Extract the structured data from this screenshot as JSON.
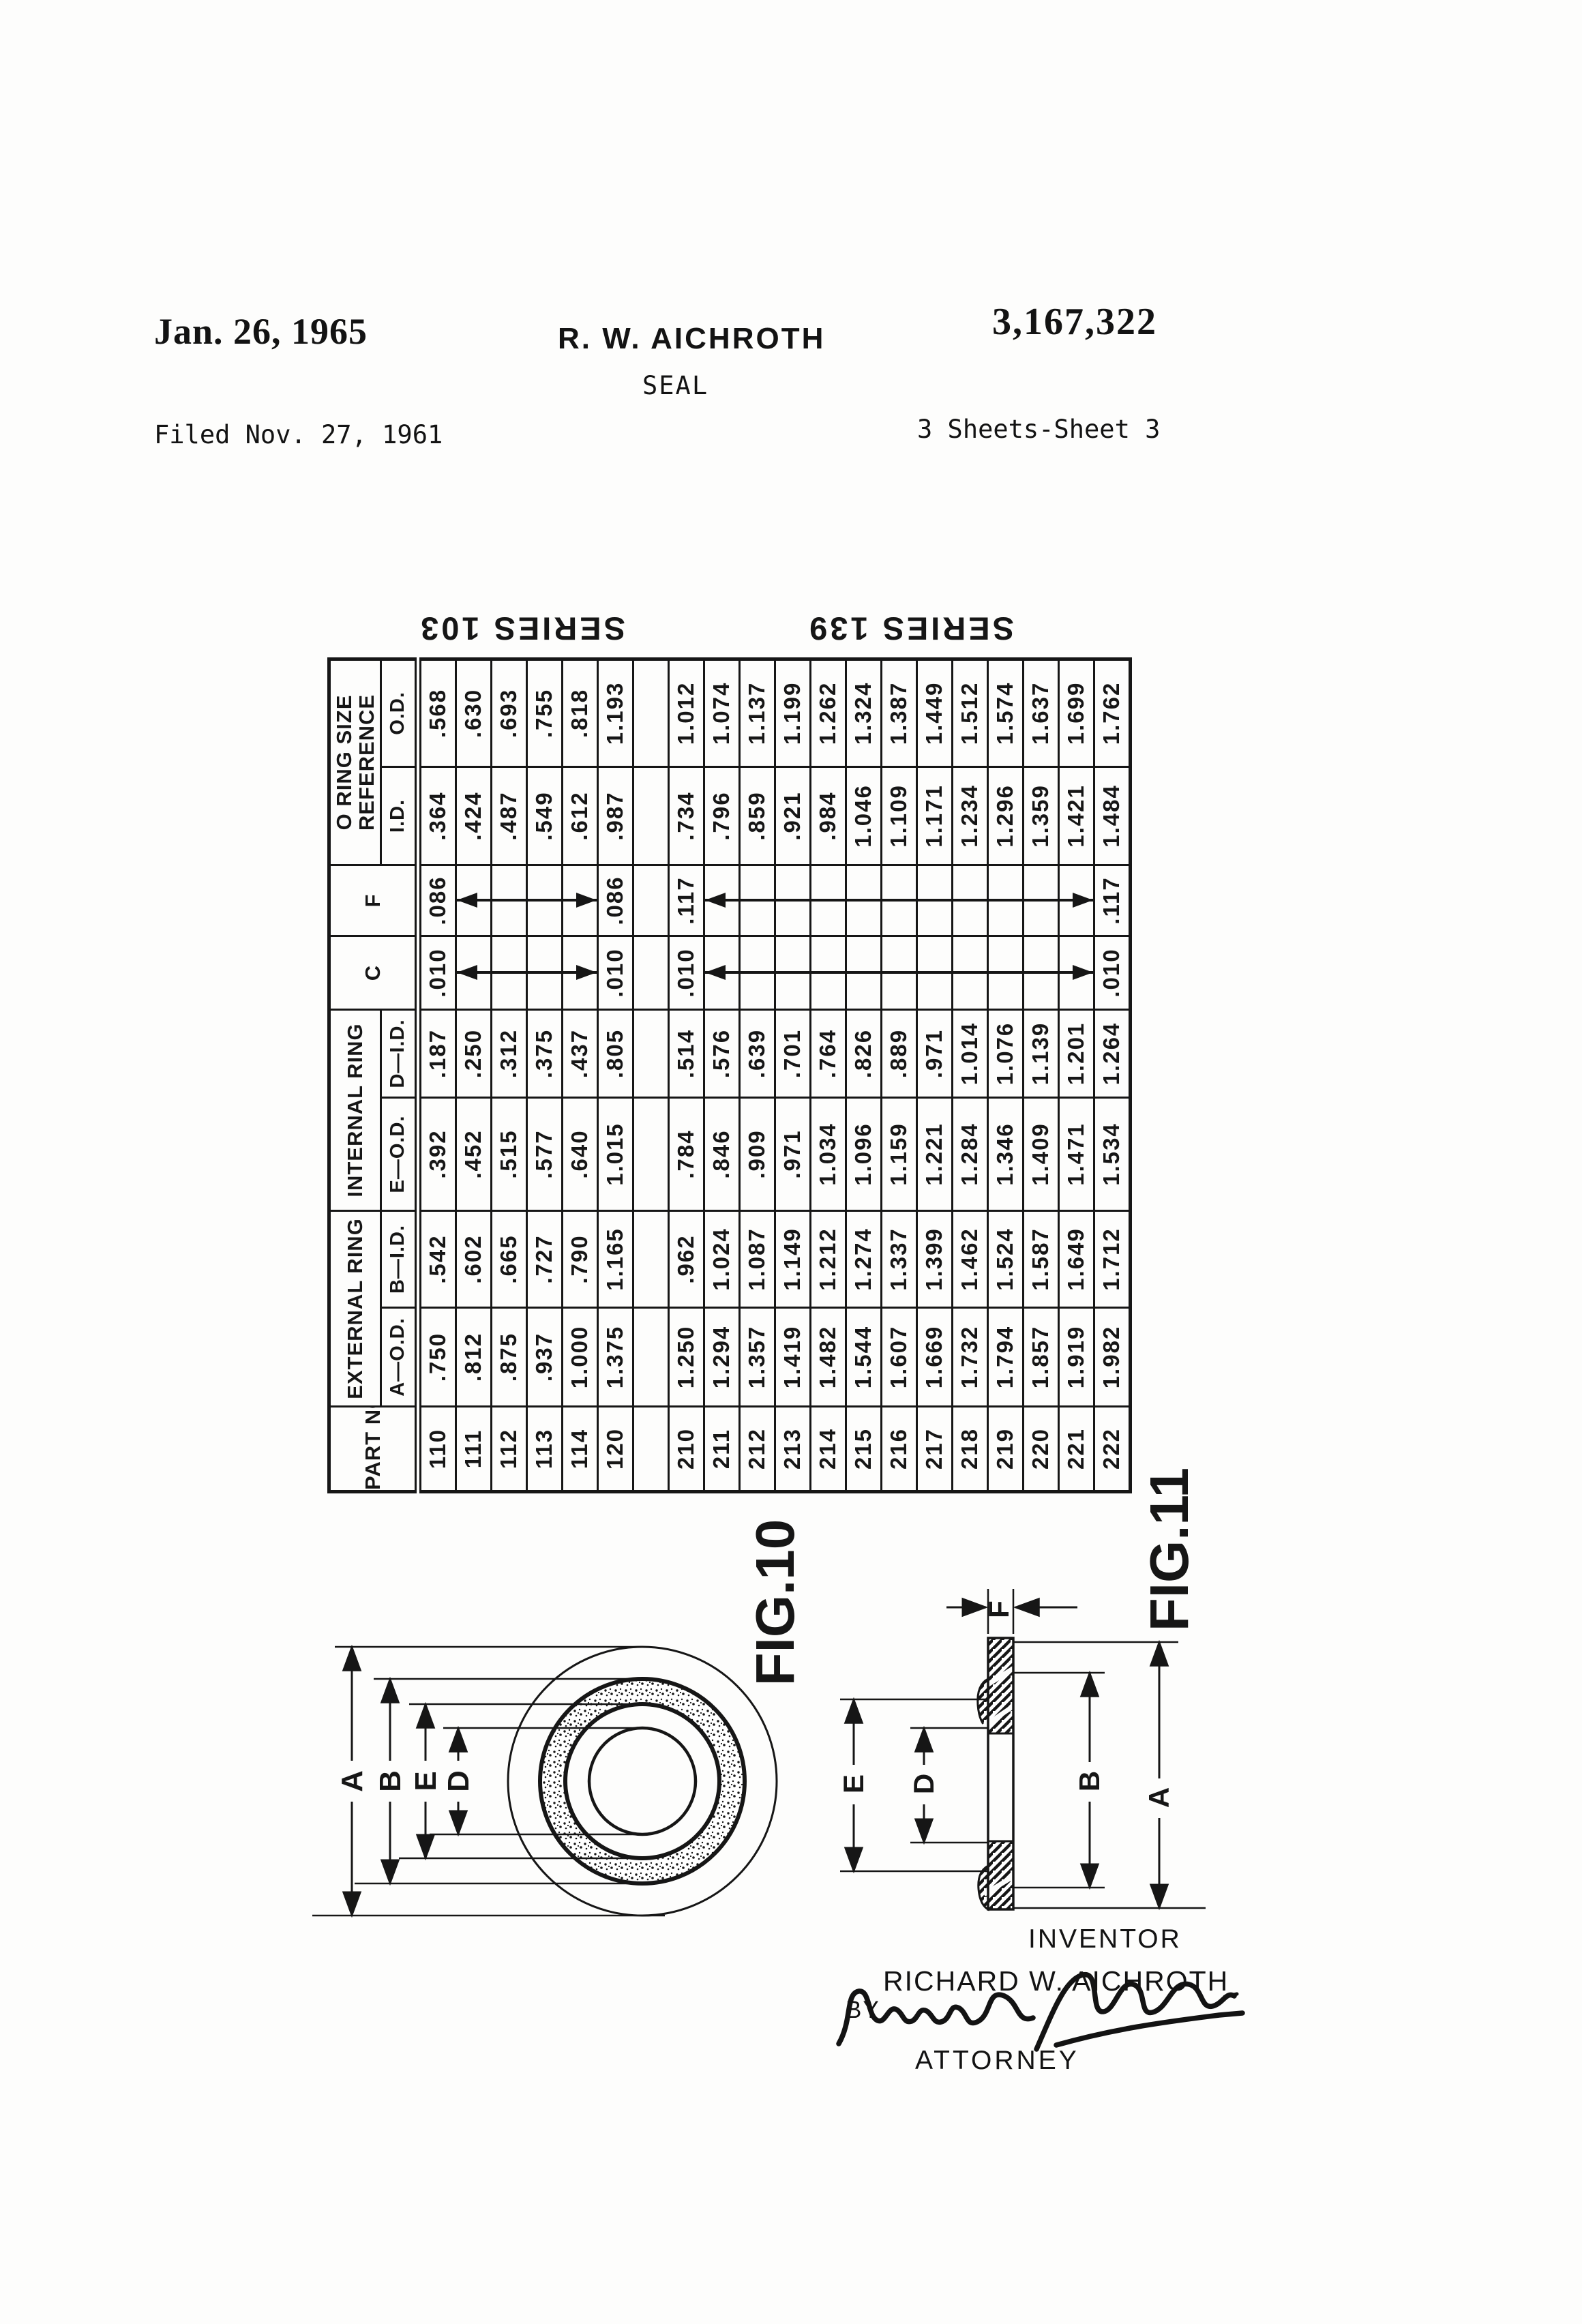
{
  "header": {
    "date": "Jan. 26, 1965",
    "author": "R. W. AICHROTH",
    "patent_number": "3,167,322",
    "title": "SEAL",
    "filed": "Filed Nov. 27, 1961",
    "sheet_info": "3 Sheets-Sheet 3"
  },
  "table": {
    "headers": {
      "part_no": "PART NO.",
      "external_ring": "EXTERNAL RING",
      "internal_ring": "INTERNAL RING",
      "c": "C",
      "f": "F",
      "o_ring_line1": "O RING SIZE",
      "o_ring_line2": "REFERENCE",
      "a_od": "A—O.D.",
      "b_id": "B—I.D.",
      "e_od": "E—O.D.",
      "d_id": "D—I.D.",
      "id": "I.D.",
      "od": "O.D."
    },
    "series_labels": [
      "SERIES 103",
      "SERIES 139"
    ],
    "columns": [
      "part",
      "a_od",
      "b_id",
      "e_od",
      "d_id",
      "c",
      "f",
      "id",
      "od"
    ],
    "rows": [
      {
        "part": "110",
        "a_od": ".750",
        "b_id": ".542",
        "e_od": ".392",
        "d_id": ".187",
        "c": ".010",
        "f": ".086",
        "id": ".364",
        "od": ".568"
      },
      {
        "part": "111",
        "a_od": ".812",
        "b_id": ".602",
        "e_od": ".452",
        "d_id": ".250",
        "c": "",
        "f": "",
        "id": ".424",
        "od": ".630"
      },
      {
        "part": "112",
        "a_od": ".875",
        "b_id": ".665",
        "e_od": ".515",
        "d_id": ".312",
        "c": "",
        "f": "",
        "id": ".487",
        "od": ".693"
      },
      {
        "part": "113",
        "a_od": ".937",
        "b_id": ".727",
        "e_od": ".577",
        "d_id": ".375",
        "c": "",
        "f": "",
        "id": ".549",
        "od": ".755"
      },
      {
        "part": "114",
        "a_od": "1.000",
        "b_id": ".790",
        "e_od": ".640",
        "d_id": ".437",
        "c": "",
        "f": "",
        "id": ".612",
        "od": ".818"
      },
      {
        "part": "120",
        "a_od": "1.375",
        "b_id": "1.165",
        "e_od": "1.015",
        "d_id": ".805",
        "c": ".010",
        "f": ".086",
        "id": ".987",
        "od": "1.193"
      },
      {
        "gap": true
      },
      {
        "part": "210",
        "a_od": "1.250",
        "b_id": ".962",
        "e_od": ".784",
        "d_id": ".514",
        "c": ".010",
        "f": ".117",
        "id": ".734",
        "od": "1.012"
      },
      {
        "part": "211",
        "a_od": "1.294",
        "b_id": "1.024",
        "e_od": ".846",
        "d_id": ".576",
        "c": "",
        "f": "",
        "id": ".796",
        "od": "1.074"
      },
      {
        "part": "212",
        "a_od": "1.357",
        "b_id": "1.087",
        "e_od": ".909",
        "d_id": ".639",
        "c": "",
        "f": "",
        "id": ".859",
        "od": "1.137"
      },
      {
        "part": "213",
        "a_od": "1.419",
        "b_id": "1.149",
        "e_od": ".971",
        "d_id": ".701",
        "c": "",
        "f": "",
        "id": ".921",
        "od": "1.199"
      },
      {
        "part": "214",
        "a_od": "1.482",
        "b_id": "1.212",
        "e_od": "1.034",
        "d_id": ".764",
        "c": "",
        "f": "",
        "id": ".984",
        "od": "1.262"
      },
      {
        "part": "215",
        "a_od": "1.544",
        "b_id": "1.274",
        "e_od": "1.096",
        "d_id": ".826",
        "c": "",
        "f": "",
        "id": "1.046",
        "od": "1.324"
      },
      {
        "part": "216",
        "a_od": "1.607",
        "b_id": "1.337",
        "e_od": "1.159",
        "d_id": ".889",
        "c": "",
        "f": "",
        "id": "1.109",
        "od": "1.387"
      },
      {
        "part": "217",
        "a_od": "1.669",
        "b_id": "1.399",
        "e_od": "1.221",
        "d_id": ".971",
        "c": "",
        "f": "",
        "id": "1.171",
        "od": "1.449"
      },
      {
        "part": "218",
        "a_od": "1.732",
        "b_id": "1.462",
        "e_od": "1.284",
        "d_id": "1.014",
        "c": "",
        "f": "",
        "id": "1.234",
        "od": "1.512"
      },
      {
        "part": "219",
        "a_od": "1.794",
        "b_id": "1.524",
        "e_od": "1.346",
        "d_id": "1.076",
        "c": "",
        "f": "",
        "id": "1.296",
        "od": "1.574"
      },
      {
        "part": "220",
        "a_od": "1.857",
        "b_id": "1.587",
        "e_od": "1.409",
        "d_id": "1.139",
        "c": "",
        "f": "",
        "id": "1.359",
        "od": "1.637"
      },
      {
        "part": "221",
        "a_od": "1.919",
        "b_id": "1.649",
        "e_od": "1.471",
        "d_id": "1.201",
        "c": "",
        "f": "",
        "id": "1.421",
        "od": "1.699"
      },
      {
        "part": "222",
        "a_od": "1.982",
        "b_id": "1.712",
        "e_od": "1.534",
        "d_id": "1.264",
        "c": ".010",
        "f": ".117",
        "id": "1.484",
        "od": "1.762"
      }
    ],
    "arrow_spans": {
      "c": [
        [
          "111",
          "114"
        ],
        [
          "211",
          "221"
        ]
      ],
      "f": [
        [
          "111",
          "114"
        ],
        [
          "211",
          "221"
        ]
      ]
    }
  },
  "fig10": {
    "label": "FIG.10",
    "dim_letters": {
      "a": "A",
      "b": "B",
      "e": "E",
      "d": "D"
    }
  },
  "fig11": {
    "label": "FIG.11",
    "dim_letters": {
      "a": "A",
      "b": "B",
      "d": "D",
      "e": "E",
      "f": "F"
    }
  },
  "signature_block": {
    "inventor_heading": "INVENTOR",
    "inventor_name": "RICHARD W. AICHROTH",
    "by_label": "BY",
    "attorney_label": "ATTORNEY"
  }
}
